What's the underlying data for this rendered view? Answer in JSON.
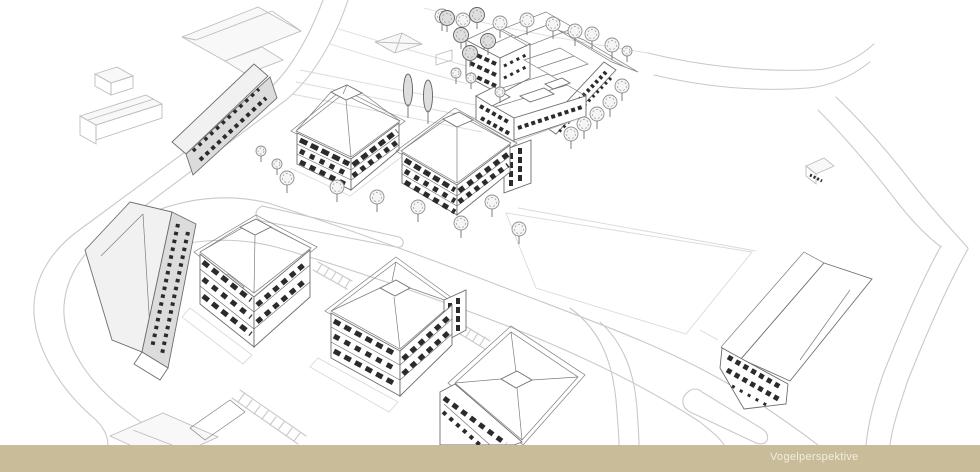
{
  "caption_bar": {
    "label": "Vogelperspektive",
    "background": "#c9bc98",
    "text_color": "#f2eee2"
  },
  "canvas": {
    "width": 980,
    "height": 472,
    "background": "#ffffff"
  },
  "palette": {
    "ink": "#6e6e6e",
    "ink_light": "#bdbdbd",
    "road": "#c9c9c9",
    "roof_hatch": "#a2a2a2",
    "window": "#2b2b2b",
    "facade_shade": "#dcdcdc"
  },
  "scene": {
    "description": "Bird's-eye architectural pencil sketch of a residential development: hip-roofed apartment blocks, a perimeter housing complex, tree-lined streets, parking strips, an open field and surrounding context buildings"
  }
}
